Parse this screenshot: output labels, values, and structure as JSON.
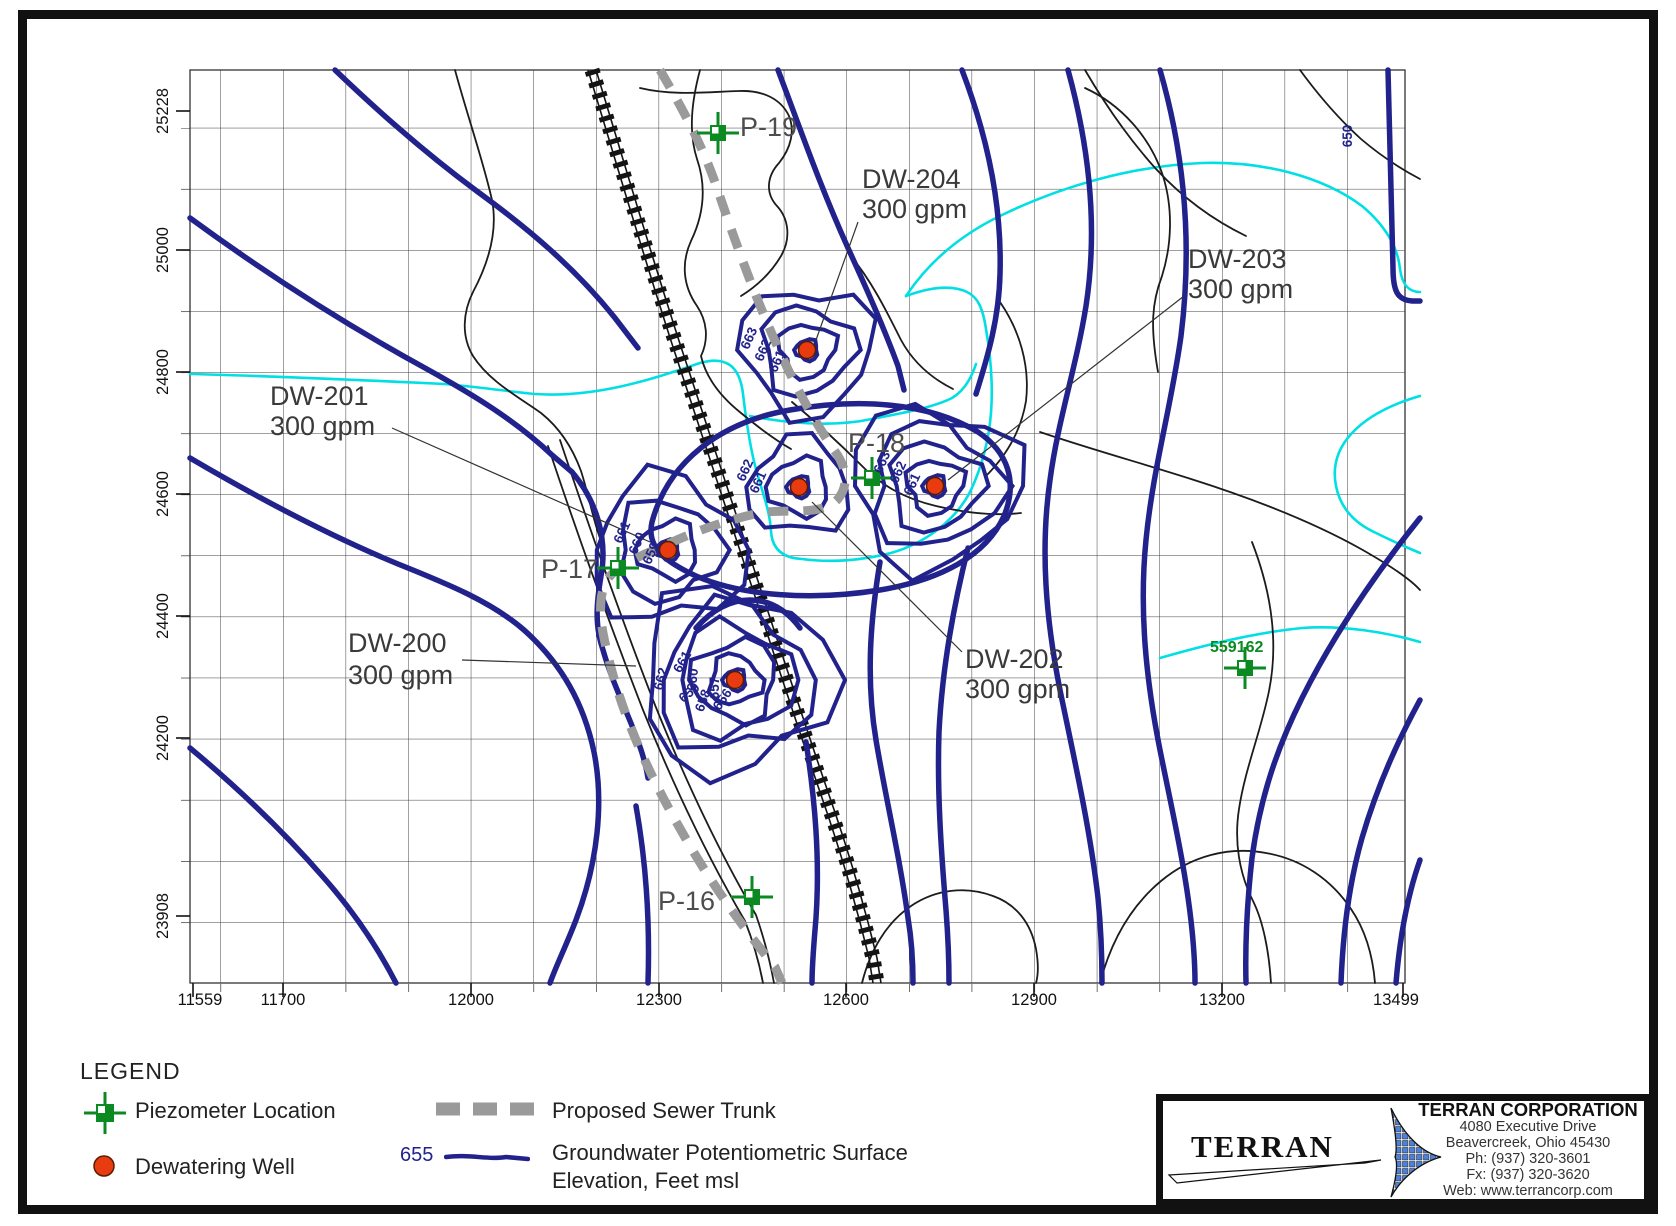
{
  "colors": {
    "contour": "#22228c",
    "stream": "#00dfe4",
    "piezometer": "#0a8a20",
    "well": "#e83c10",
    "sewer": "#9a9a9a",
    "railroad": "#141414"
  },
  "map": {
    "x_axis": [
      "11559",
      "11700",
      "12000",
      "12300",
      "12600",
      "12900",
      "13200",
      "13499"
    ],
    "y_axis": [
      "25228",
      "25000",
      "24800",
      "24600",
      "24400",
      "24200",
      "23908"
    ],
    "wells": [
      {
        "id": "DW-200",
        "rate": "300 gpm",
        "x": 735,
        "y": 680,
        "rings": [
          11,
          26,
          42,
          58,
          76,
          96
        ]
      },
      {
        "id": "DW-201",
        "rate": "300 gpm",
        "x": 668,
        "y": 550,
        "rings": [
          11,
          30,
          52,
          76
        ]
      },
      {
        "id": "DW-202",
        "rate": "300 gpm",
        "x": 799,
        "y": 487,
        "rings": [
          11,
          30,
          50
        ]
      },
      {
        "id": "DW-203",
        "rate": "300 gpm",
        "x": 935,
        "y": 486,
        "rings": [
          11,
          28,
          46,
          64,
          84
        ]
      },
      {
        "id": "DW-204",
        "rate": "300 gpm",
        "x": 807,
        "y": 350,
        "rings": [
          11,
          28,
          46,
          66
        ]
      }
    ],
    "piezometers": [
      {
        "id": "P-19",
        "x": 718,
        "y": 133
      },
      {
        "id": "P-18",
        "x": 872,
        "y": 478
      },
      {
        "id": "P-17",
        "x": 618,
        "y": 568
      },
      {
        "id": "P-16",
        "x": 752,
        "y": 897
      },
      {
        "id": "559162",
        "x": 1245,
        "y": 668
      }
    ],
    "contour_labels": [
      {
        "v": "663",
        "x": 753,
        "y": 340,
        "r": -66
      },
      {
        "v": "662",
        "x": 767,
        "y": 352,
        "r": -66
      },
      {
        "v": "661",
        "x": 781,
        "y": 363,
        "r": -66
      },
      {
        "v": "662",
        "x": 749,
        "y": 472,
        "r": -66
      },
      {
        "v": "661",
        "x": 762,
        "y": 484,
        "r": -66
      },
      {
        "v": "663",
        "x": 886,
        "y": 464,
        "r": -66
      },
      {
        "v": "662",
        "x": 902,
        "y": 474,
        "r": -66
      },
      {
        "v": "661",
        "x": 916,
        "y": 486,
        "r": -66
      },
      {
        "v": "661",
        "x": 626,
        "y": 534,
        "r": -66
      },
      {
        "v": "660",
        "x": 641,
        "y": 545,
        "r": -66
      },
      {
        "v": "659",
        "x": 655,
        "y": 555,
        "r": -66
      },
      {
        "v": "661",
        "x": 686,
        "y": 664,
        "r": -60
      },
      {
        "v": "660",
        "x": 697,
        "y": 680,
        "r": -85
      },
      {
        "v": "659",
        "x": 692,
        "y": 696,
        "r": -40
      },
      {
        "v": "658",
        "x": 707,
        "y": 702,
        "r": -70
      },
      {
        "v": "657",
        "x": 719,
        "y": 688,
        "r": -90
      },
      {
        "v": "656",
        "x": 726,
        "y": 702,
        "r": -55
      },
      {
        "v": "662",
        "x": 665,
        "y": 680,
        "r": -75
      },
      {
        "v": "650",
        "x": 1352,
        "y": 136,
        "r": -90
      }
    ]
  },
  "legend": {
    "title": "LEGEND",
    "piezometer": "Piezometer Location",
    "well": "Dewatering Well",
    "sewer": "Proposed Sewer Trunk",
    "gw_value": "655",
    "gw_line1": "Groundwater Potentiometric Surface",
    "gw_line2": "Elevation, Feet msl"
  },
  "terran": {
    "logo": "TERRAN",
    "name": "TERRAN CORPORATION",
    "address1": "4080 Executive Drive",
    "address2": "Beavercreek, Ohio 45430",
    "phone": "Ph: (937) 320-3601",
    "fax": "Fx: (937) 320-3620",
    "web": "Web: www.terrancorp.com"
  }
}
